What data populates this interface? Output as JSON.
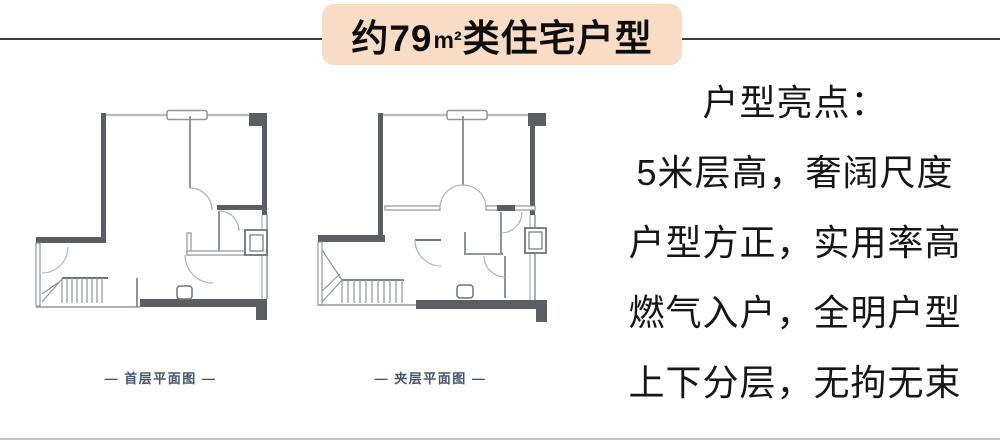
{
  "title": {
    "prefix": "约79",
    "unit": "m²",
    "suffix": "类住宅户型"
  },
  "plans": [
    {
      "label": "— 首层平面图 —"
    },
    {
      "label": "— 夹层平面图 —"
    }
  ],
  "highlights": {
    "heading": "户型亮点：",
    "items": [
      "5米层高，奢阔尺度",
      "户型方正，实用率高",
      "燃气入户，全明户型",
      "上下分层，无拘无束"
    ]
  },
  "colors": {
    "banner_background": "#f8dcc5",
    "title_text": "#0e0e0e",
    "top_rule": "#3d3d3d",
    "bottom_rule": "#c3c6c6",
    "wall_dark": "#5b5e63",
    "wall_thin": "#8f959b",
    "wall_light": "#b9bec3",
    "plan_label": "#44566c",
    "highlight_text": "#161616"
  }
}
